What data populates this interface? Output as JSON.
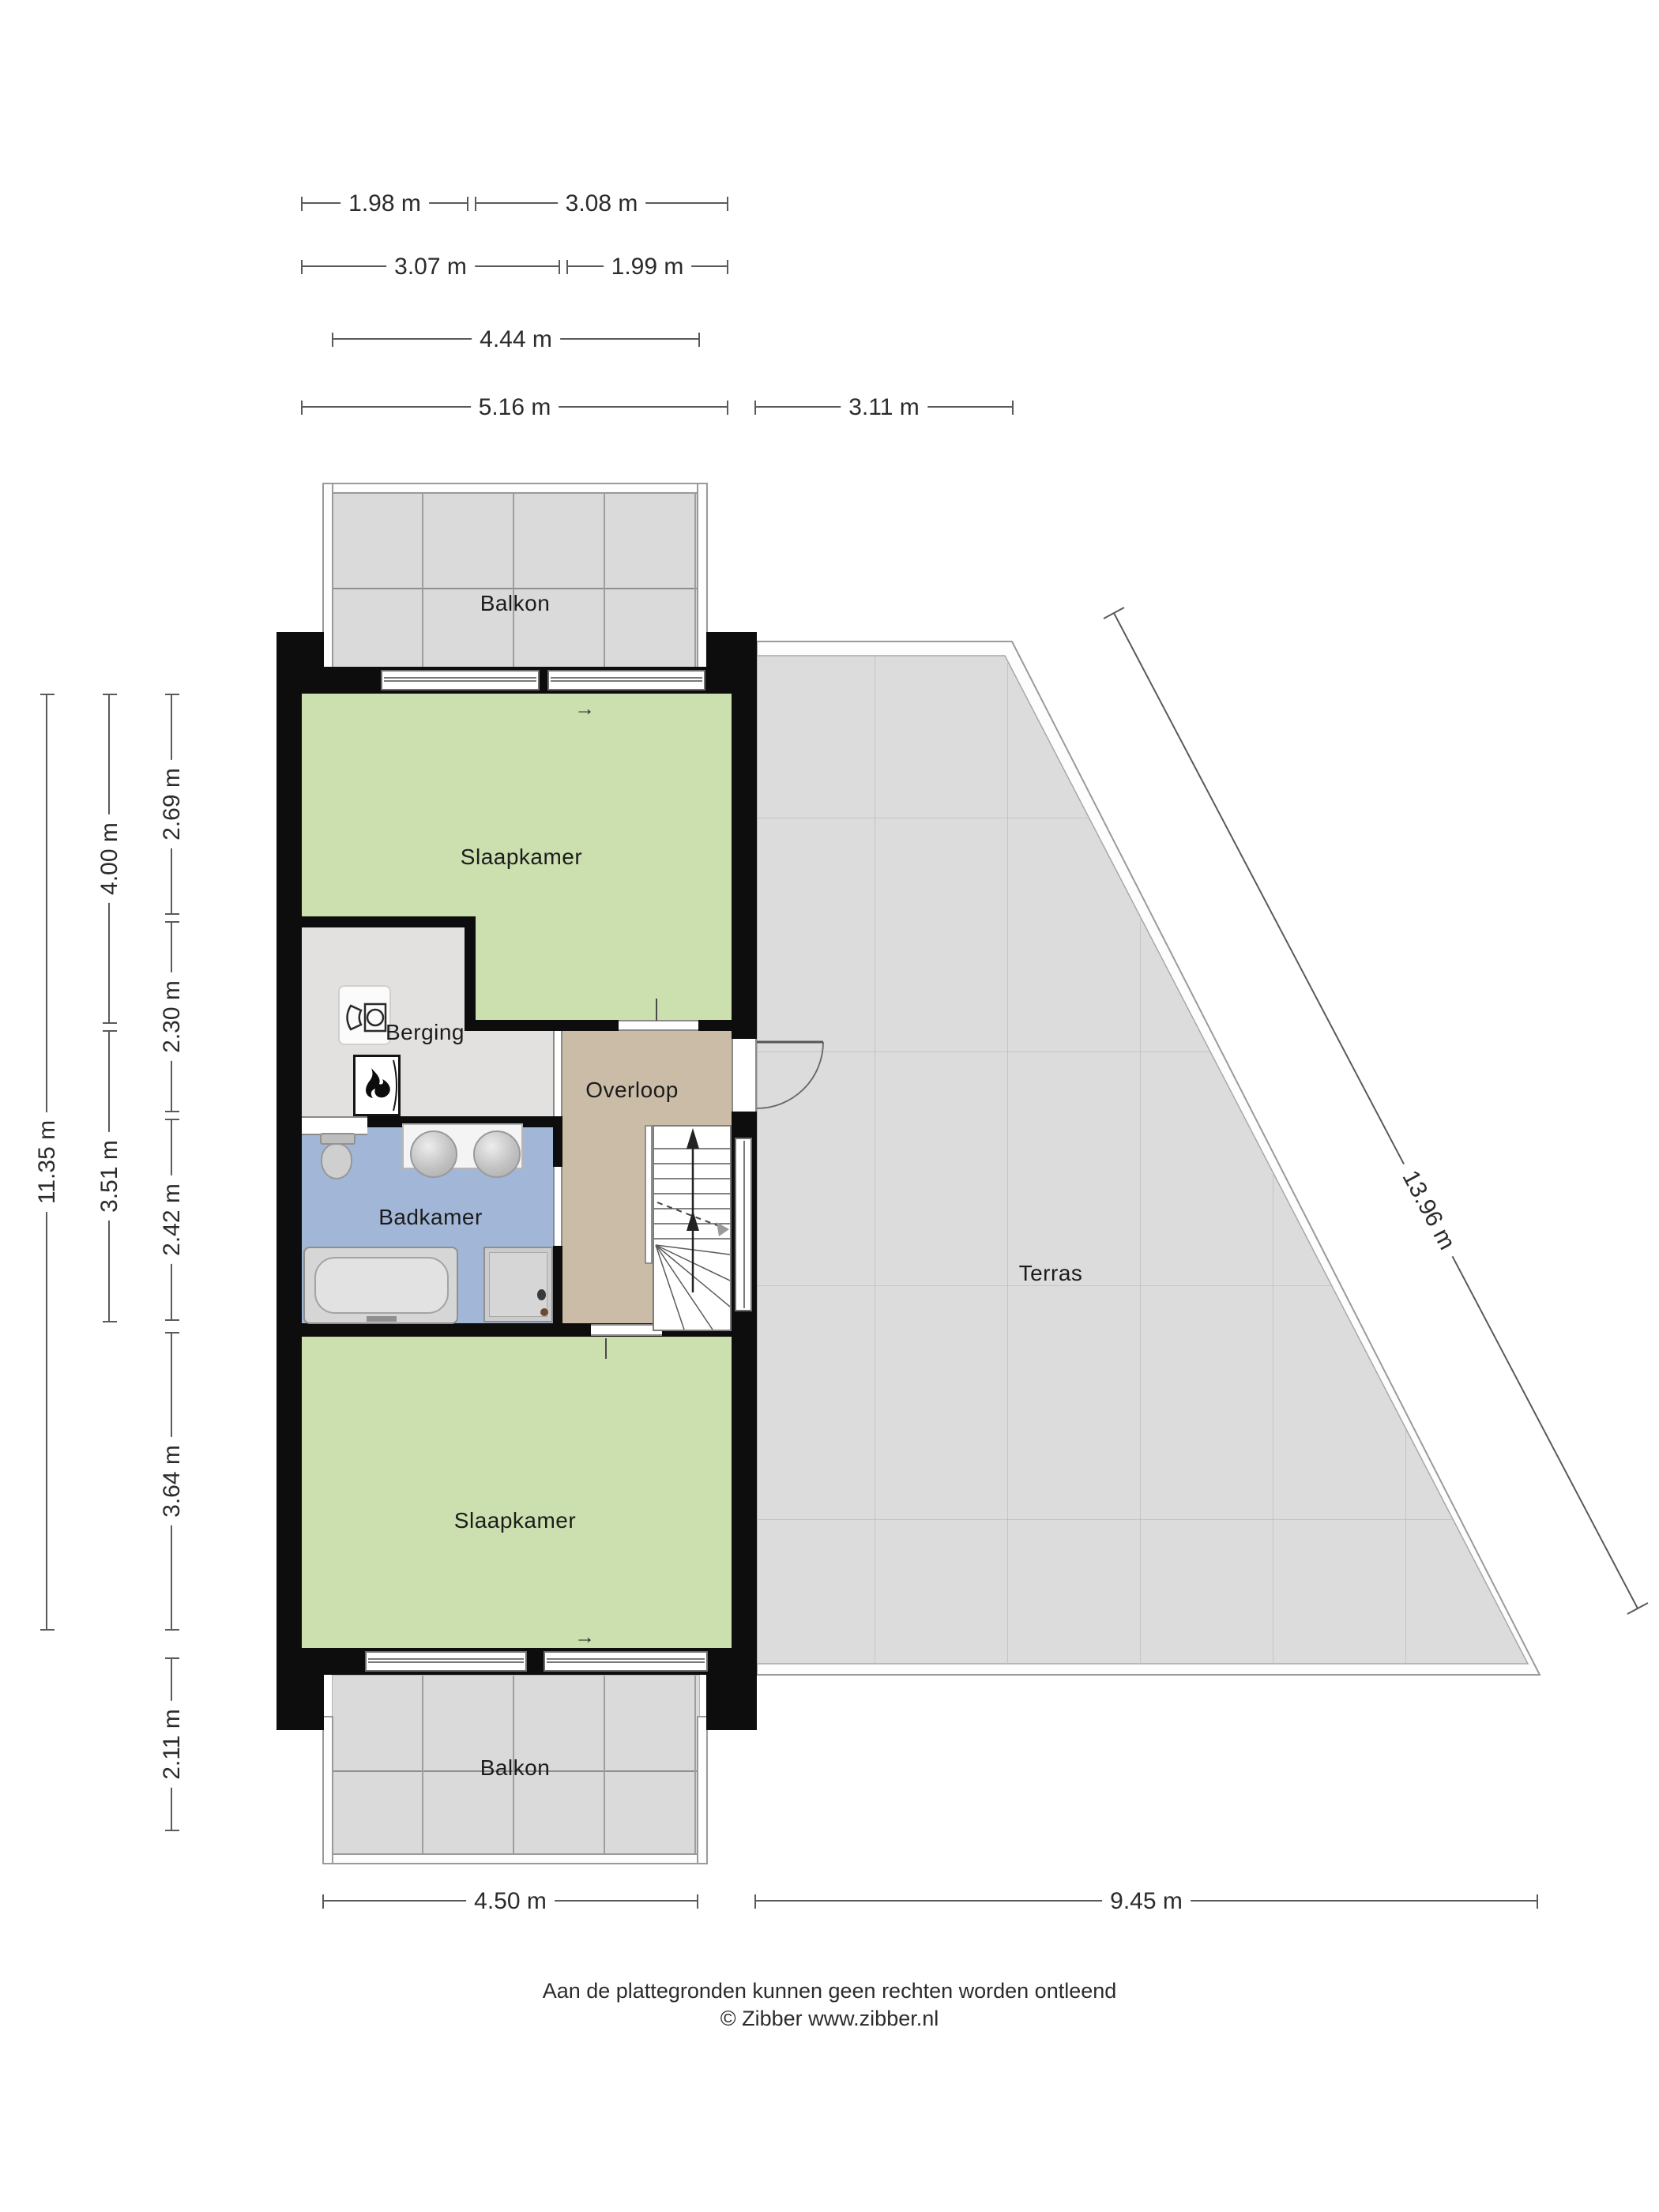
{
  "rooms": {
    "balkon_top": "Balkon",
    "slaapkamer_top": "Slaapkamer",
    "berging": "Berging",
    "overloop": "Overloop",
    "badkamer": "Badkamer",
    "slaapkamer_bottom": "Slaapkamer",
    "balkon_bottom": "Balkon",
    "terras": "Terras"
  },
  "dimensions": {
    "top": [
      "1.98 m",
      "3.08 m",
      "3.07 m",
      "1.99 m",
      "4.44 m",
      "5.16 m",
      "3.11 m"
    ],
    "left": [
      "11.35 m",
      "4.00 m",
      "3.51 m",
      "2.69 m",
      "2.30 m",
      "2.42 m",
      "3.64 m",
      "2.11 m"
    ],
    "bottom": [
      "4.50 m",
      "9.45 m"
    ],
    "diagonal": "13.96 m"
  },
  "footer": {
    "disclaimer": "Aan de plattegronden kunnen geen rechten worden ontleend",
    "copyright": "© Zibber www.zibber.nl"
  },
  "colors": {
    "wall": "#0d0d0d",
    "bedroom_green": "#cbe0ae",
    "storage_grey": "#e2e1df",
    "landing_tan": "#cbbca8",
    "bathroom_blue": "#a2b7d7",
    "balcony_tile": "#dadada",
    "terrace_tile": "#dcdcdc",
    "dimension_line": "#5a5a5a"
  },
  "icons": {
    "washing_machine": "washing-machine-icon",
    "boiler": "boiler-flame-icon",
    "stairs_up": "stairs-up-arrow-icon",
    "door_swing": "door-swing-arc-icon",
    "window_arrow": "→"
  }
}
